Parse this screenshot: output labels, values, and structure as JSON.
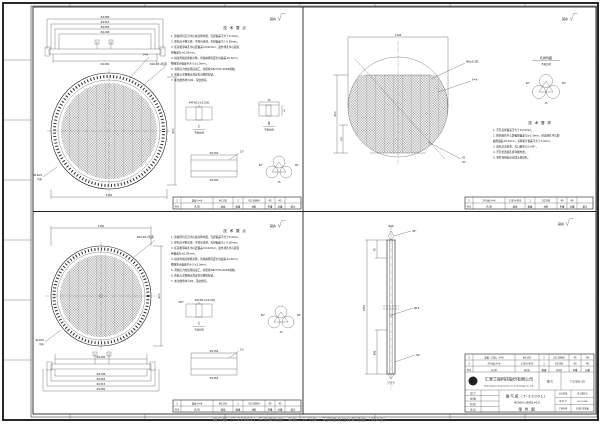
{
  "sheet": {
    "roughness": "其余",
    "caption": "脱气塔（T-22001）内件零件图：筛板、升气板、支撑圈及拉杆制造图（共4张）"
  },
  "bom_headers": [
    "件号",
    "名  称",
    "规格",
    "数量",
    "材料",
    "单重",
    "总重",
    "备注"
  ],
  "q1": {
    "notes_title": "技 术 要 点",
    "notes": [
      "1. 筛板所有孔沿中心线对称布置，孔距偏差不大于0.4mm。",
      "2. 筛孔应平整光滑、不得有毛刺，孔径偏差为＋0.38mm。",
      "3. 任意相邻两孔中心距偏差±0.62mm，最外排孔中心圆直",
      "    径偏差为±0.05mm。",
      "4. 拼接焊缝应修磨平整，焊缝两侧孔距允许偏差±0.6mm，",
      "    整圈累计偏差不大于±2.0mm。",
      "5. 消除应力热处理后加工，材质按GB/T700-2006验收。",
      "6. 筛板与支撑圈点焊定位后整体配钻。",
      "7. 未注倒角均为R2，锐边倒钝。"
    ],
    "dims_above": [
      "Φ1380",
      "Φ1315",
      "Φ1262",
      "Φ1196"
    ],
    "dim_below": "Φ1200",
    "balloon1": "1",
    "balloon2": "2",
    "dim_width": "1150",
    "dim_height": "900",
    "leader_pitch": "940-Φ5.2孔距",
    "leader_thk": "δ=6",
    "leader_holes1": "40-Φ22",
    "leader_holes2": "均布",
    "detail1_top": "940-Φ5.2±0.25孔",
    "detail1_title": "Ⅰ",
    "detail1_sub": "不按比例",
    "detail2_dim1": "24",
    "detail2_dim2": "8",
    "detail2_title": "Ⅱ",
    "detail2_sub": "不按比例",
    "sec_dim_top": "Φ1150",
    "sec_dim_bot": "Φ1200",
    "sec_angle": "15°",
    "holes_angle1": "60°",
    "holes_angle2": "60°",
    "holes_pitch": "15",
    "bom_row": [
      "1",
      "筛板 δ=6",
      "Φ1150",
      "1",
      "0Cr18Ni9",
      "45",
      "45",
      ""
    ]
  },
  "q2": {
    "notes_title": "技 术 要 求",
    "notes": [
      "1. 开孔直径偏差不大于±0.3mm。",
      "2. 相邻两孔中心距极限偏差为±0.3mm，任意两孔中心距",
      "    极限偏差±0.6mm，对称累计偏差不大于1.0mm。",
      "3. 钻孔后去毛刺，孔口倒角0.5×45°。",
      "4. 开孔位置按孔排列图布置。",
      "5. 零件卷制前应完成全部钻孔。"
    ],
    "dim_top": "1192",
    "dim_left1": "950",
    "dim_left2": "300",
    "leader_hole": "Φ8±0.2孔",
    "leader_thk": "δ=6",
    "leader_r": "R2",
    "leader_angle": "45°",
    "holes_title": "孔排列图",
    "holes_sub": "不按比例",
    "holes_angle1": "60°",
    "holes_angle2": "60°",
    "holes_pitch": "15",
    "bom_row": [
      "2",
      "升气板 δ=6",
      "1192×950",
      "1",
      "Q235B",
      "40",
      "40",
      ""
    ]
  },
  "q3": {
    "notes_title": "技 术 要 点",
    "dim_width": "1150",
    "dim_height": "900",
    "leader_pitch": "940-Φ5.2孔距",
    "leader_holes1": "40-Φ22",
    "leader_holes2": "均布",
    "dim_above": "Φ1200",
    "dims_below": [
      "Φ1196",
      "Φ1262",
      "Φ1315",
      "Φ1380"
    ],
    "balloon1": "1",
    "balloon2": "2",
    "detail1_top": "940-Φ5.2±0.25孔",
    "detail1_angle": "150°",
    "detail1_title": "Ⅰ",
    "detail1_sub": "平面布置",
    "sec_dim_top": "Φ1150",
    "sec_dim_bot": "Φ1262",
    "sec_angle": "15°",
    "holes_angle1": "60°",
    "holes_angle2": "60°",
    "holes_pitch": "15",
    "bom_row": [
      "3",
      "筛板 δ=6",
      "Φ1150",
      "1",
      "0Cr18Ni9",
      "45",
      "45",
      ""
    ]
  },
  "q4": {
    "dim_full": "1850",
    "dim_top": "70",
    "dim_bot": "600",
    "label_dia": "Φ16",
    "leader_top": "30°",
    "leader_bot": "30°",
    "bom": {
      "headers": [
        "件号",
        "名    称",
        "规 格",
        "数量",
        "材 料",
        "单重",
        "总重"
      ],
      "rows": [
        [
          "3",
          "筛板（开孔）δ=6",
          "Φ1150",
          "2",
          "0Cr18Ni9",
          "45",
          "90"
        ],
        [
          "2",
          "升气板 δ=6",
          "1192×950",
          "1",
          "Q235B",
          "40",
          "40"
        ]
      ]
    },
    "tb": {
      "logo_letter": "汇",
      "company_cn": "汇里工程科技股份有限公司",
      "company_en": "Huili Engineering Science & Technology Co.,Ltd.",
      "doc_no_label": "图 号",
      "doc_no": "T-22001-05",
      "sign_rows": [
        "设 计",
        "制 图",
        "校 核",
        "审 定"
      ],
      "title1": "脱气塔（T-22001）",
      "title2": "Φ2000×28982×6-8",
      "title3": "零 件 图",
      "right_rows": [
        [
          "设计阶段",
          "施工图设计"
        ],
        [
          "项 目 号",
          "HL23-046"
        ],
        [
          "工程名称",
          "技改扩建装置"
        ]
      ]
    }
  }
}
